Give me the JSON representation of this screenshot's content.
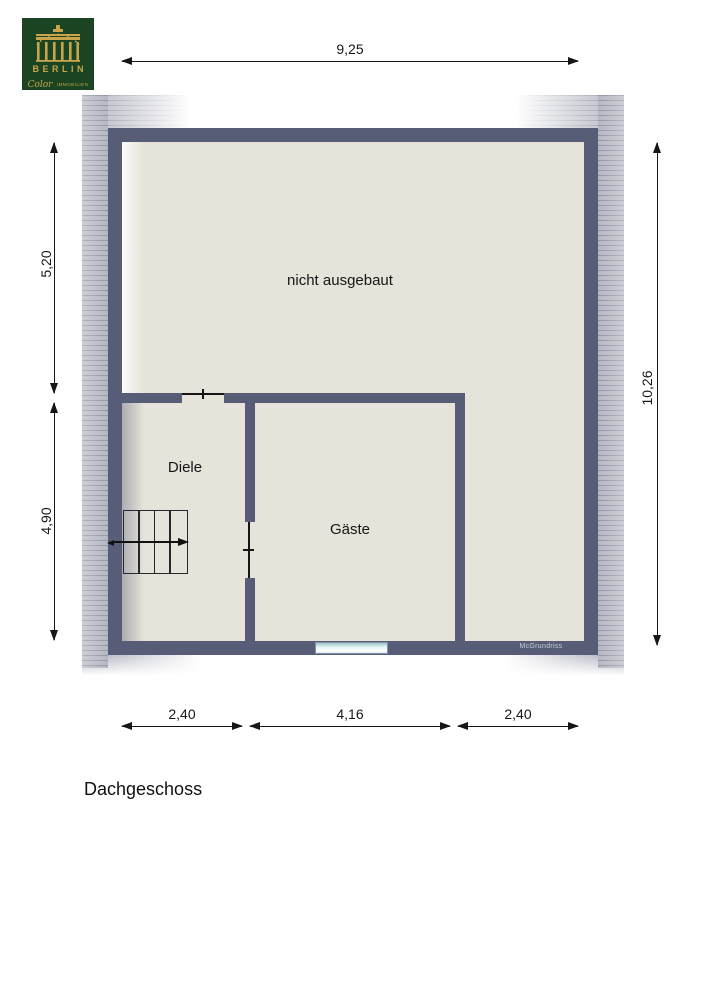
{
  "page": {
    "title": "Dachgeschoss"
  },
  "logo": {
    "name": "BERLIN",
    "script": "Color",
    "suffix": "IMMOBILIEN"
  },
  "plan": {
    "rooms": [
      {
        "name": "nicht ausgebaut"
      },
      {
        "name": "Diele"
      },
      {
        "name": "Gäste"
      }
    ],
    "watermark": "McGrundriss"
  },
  "dimensions": {
    "top": "9,25",
    "left_upper": "5,20",
    "left_lower": "4,90",
    "right": "10,26",
    "bottom_left": "2,40",
    "bottom_middle": "4,16",
    "bottom_right": "2,40"
  },
  "colors": {
    "wall": "#585d77",
    "floor": "#e6e3da",
    "roof_band": "#b0b2bf",
    "logo_green": "#1a4422",
    "logo_gold": "#c8a44a",
    "window_fill": "#dff1f2"
  }
}
